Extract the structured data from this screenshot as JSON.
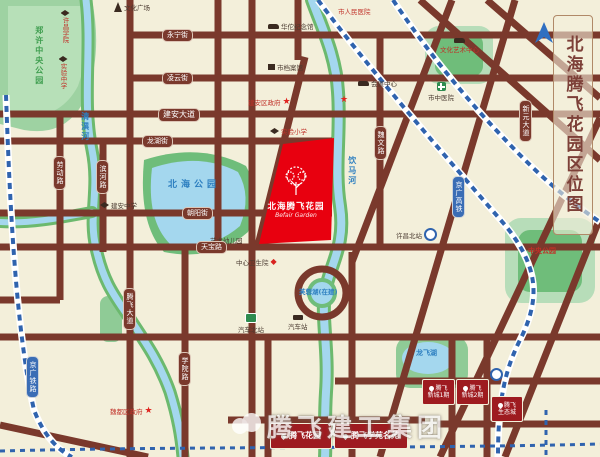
{
  "title": "北海腾飞花园区位图",
  "project_block": {
    "name": "北海腾飞花园",
    "name_en": "Befair Garden"
  },
  "parks": {
    "zhengxu_central": "郑许中央公园",
    "beihai": "北海公园",
    "central": "中央公园"
  },
  "waters": {
    "qingyi_river": "清潩河",
    "yinma_river": "饮马河",
    "furong_lake": "芙蓉湖(在建)",
    "longfei_lake": "龙飞湖"
  },
  "railways": {
    "jingguang_railway": "京广铁路",
    "jingguang_hsr": "京广高铁"
  },
  "roads": {
    "yongning": "永宁街",
    "lingyun": "凌云街",
    "jianan_avenue": "建安大道",
    "longhu": "龙湖街",
    "chaoyang": "朝阳街",
    "tianbao": "天宝路",
    "laodong": "劳动路",
    "binhe": "滨河路",
    "xueyuan": "学院路",
    "tengfei_avenue": "腾飞大道",
    "weiwen": "魏文路",
    "xinyuan_avenue": "新元大道"
  },
  "pois": {
    "wenhua_square": "文化广场",
    "xuchang_college": "许昌学院",
    "shiyan_middle": "实验中学",
    "jianan_middle": "建安中学",
    "renmin_hospital": "市人民医院",
    "huatuo_memorial": "华佗纪念馆",
    "archives": "市档案馆",
    "jianan_gov": "建安区政府",
    "shiyan_primary": "实验小学",
    "kindergarten": "艺术幼儿园",
    "health_center": "中心卫生院",
    "exhibition_center": "会展中心",
    "bus_north": "汽车北站",
    "bus_station": "汽车站",
    "north_rail_station": "许昌北站",
    "tcm_hospital": "市中医院",
    "culture_center": "文化艺术中心",
    "weidu_gov": "魏都区政府"
  },
  "projects": {
    "banner1": {
      "name": "腾飞花园"
    },
    "banner2": {
      "name": "腾飞学苑名苑"
    },
    "marker1": {
      "line1": "腾飞",
      "line2": "新城1期"
    },
    "marker2": {
      "line1": "腾飞",
      "line2": "新城2期"
    },
    "marker3": {
      "line1": "腾飞",
      "line2": "生态城"
    }
  },
  "watermark": "腾飞建工集团",
  "icons": {
    "star": "★",
    "diamond": "◆"
  },
  "colors": {
    "background": "#f3efda",
    "road": "#7a392c",
    "park": "#8fcb96",
    "water": "#a4d7ee",
    "railway_blue": "#3a6db5",
    "project_red": "#e8000f",
    "marker_red": "#9e1b20"
  }
}
